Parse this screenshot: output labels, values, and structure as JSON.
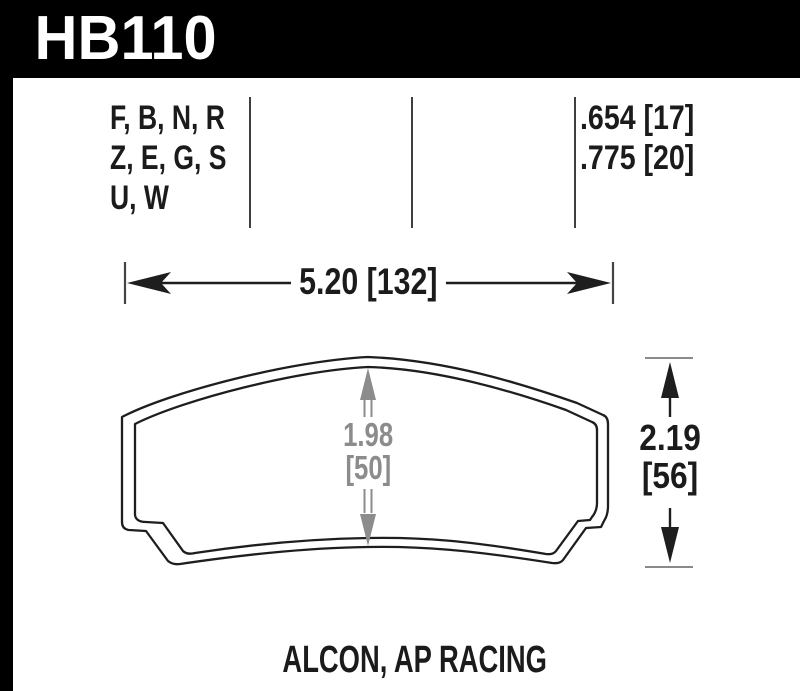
{
  "header": {
    "part_number": "HB110"
  },
  "spec_table": {
    "shape_codes": [
      "F, B, N, R",
      "Z, E, G, S",
      "U, W"
    ],
    "pad_thickness": [
      ".654 [17]",
      ".775 [20]"
    ]
  },
  "dimensions": {
    "width_label": "5.20 [132]",
    "inner_height_in": "1.98",
    "inner_height_mm": "[50]",
    "overall_height_in": "2.19",
    "overall_height_mm": "[56]"
  },
  "footer": {
    "applications": "ALCON, AP RACING"
  },
  "colors": {
    "header_bg": "#000000",
    "header_text": "#ffffff",
    "drawing_line": "#1e1e1e",
    "dimension_gray": "#8c8c8c",
    "divider_line": "#3f3f3f",
    "background": "#ffffff"
  }
}
